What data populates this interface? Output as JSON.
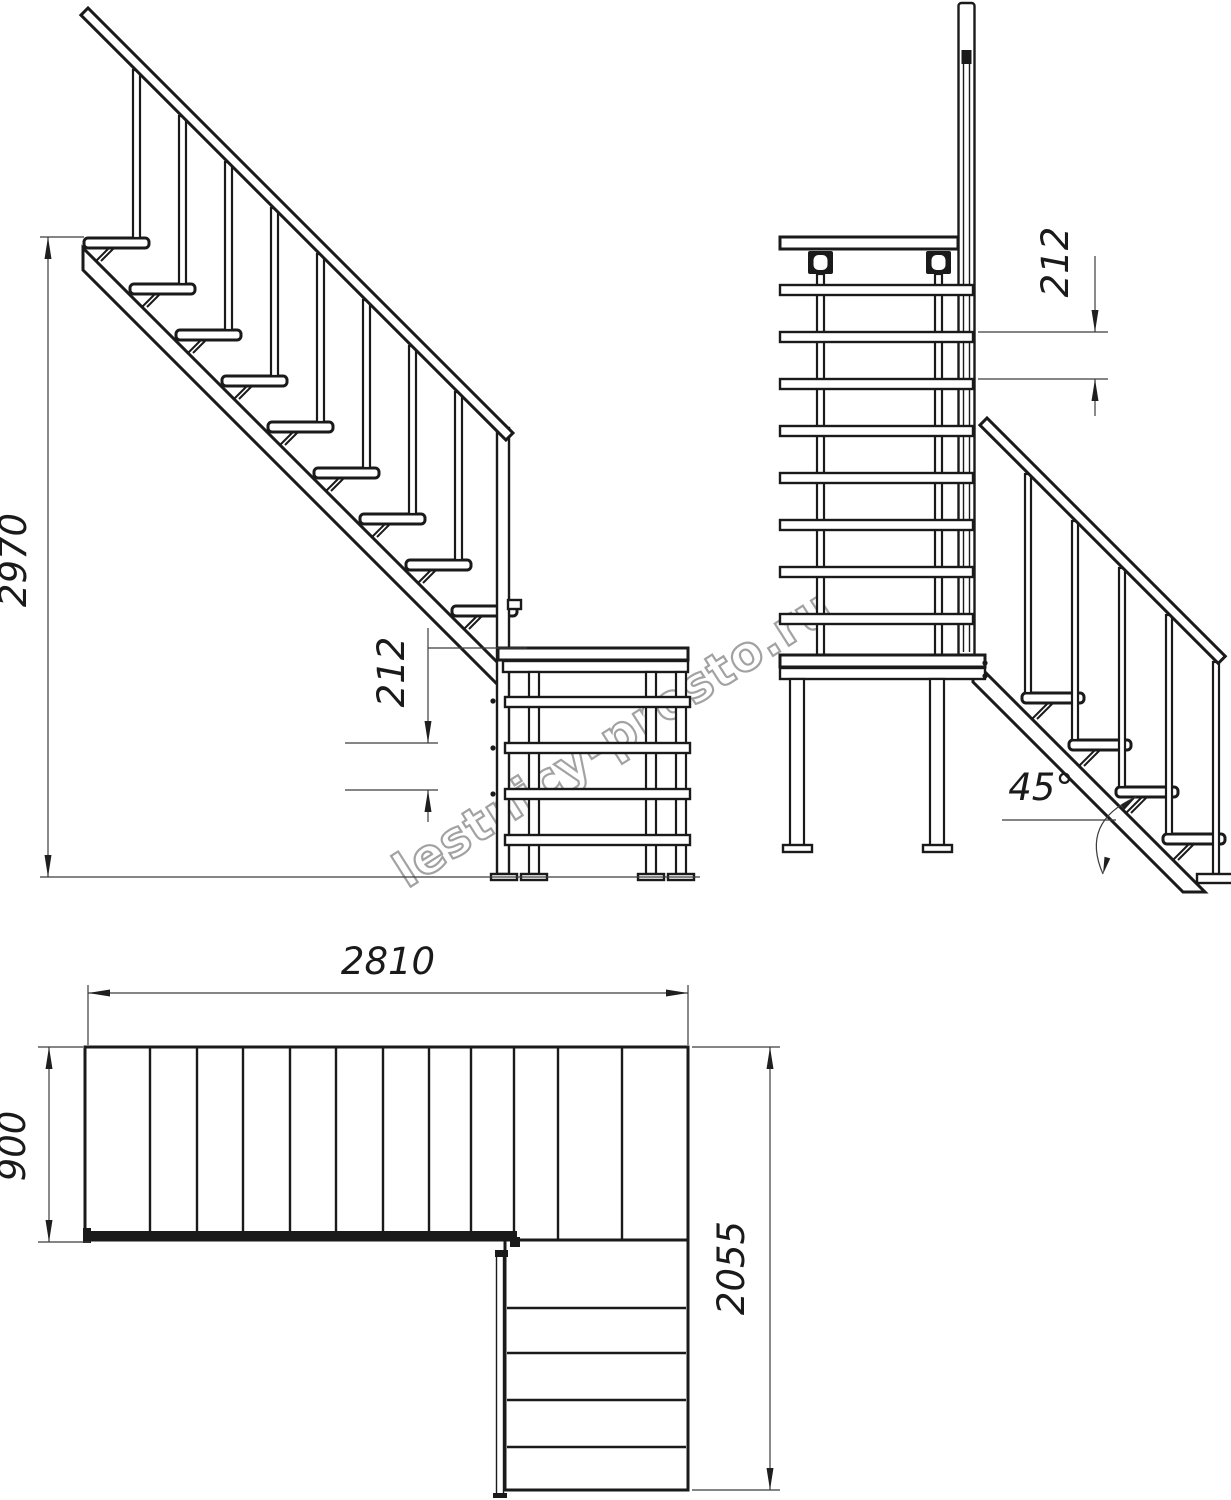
{
  "meta": {
    "watermark": "lestnicy-prosto.ru"
  },
  "colors": {
    "line": "#1a1a1a",
    "dimension": "#3c3c3c",
    "watermark_stroke": "#9e9e9e",
    "background": "#ffffff"
  },
  "dimensions": {
    "total_height": "2970",
    "step_rise_left": "212",
    "step_rise_right": "212",
    "incline_angle": "45°",
    "plan_length": "2810",
    "plan_width": "900",
    "plan_depth": "2055"
  }
}
